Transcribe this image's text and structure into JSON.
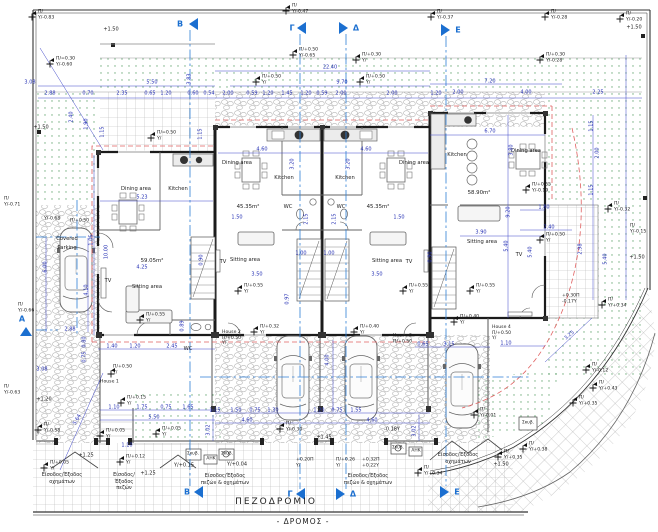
{
  "streets": {
    "sidewalk": "ΠΕΖΟΔΡΟΜΙΟ",
    "road": "- ΔΡΟΜΟΣ -"
  },
  "rooms": {
    "dining": "Dining area",
    "kitchen": "Kitchen",
    "sitting": "Sitting area",
    "tv": "TV",
    "wc": "WC",
    "covered": "Covered",
    "parking": "Parking"
  },
  "areas": {
    "h1": "59.05m²",
    "h2": "45.35m²",
    "h3": "45.35m²",
    "h4": "58.90m²"
  },
  "houses": {
    "h1": "House 1",
    "h2": "House 2",
    "h3": "House 3",
    "h4": "House 4",
    "level": "Π/+0.50",
    "datum": "Υ/"
  },
  "sections": {
    "a": "Α",
    "b": "Β",
    "g": "Γ",
    "d": "Δ",
    "e": "Ε"
  },
  "entrances": {
    "vehicles1": "Είσοδος/Έξοδος",
    "vehicles2": "οχημάτων",
    "ped1": "Είσοδος/",
    "ped2": "Έξοδος",
    "ped3": "πεζών",
    "mixed1": "Είσοδος/Έξοδος",
    "mixed2": "πεζών & οχημάτων"
  },
  "utilities": {
    "bin": "Σκυβ.",
    "power": "ΑΗΚ"
  },
  "colors": {
    "dimension": "#3e46c8",
    "section": "#1b6fd0",
    "roof_dash": "#e06060",
    "planting_dot": "#3f8f4f",
    "wall": "#1b1b1b"
  },
  "levels": [
    "+1.50",
    "+1.50",
    "+1.50",
    "+1.50",
    "+1.50",
    "+1.20",
    "+1.25",
    "+1.25",
    "+1.45",
    "Υ/+0.15",
    "Υ/+0.04"
  ],
  "dims": [
    "3.08",
    "5.50",
    "2.88",
    "0.70",
    "2.35",
    "0.65",
    "1.20",
    "0.60",
    "0.54",
    "2.00",
    "0.59",
    "1.20",
    "1.45",
    "1.20",
    "0.59",
    "2.00",
    "22.40",
    "9.70",
    "2.00",
    "2.00",
    "4.00",
    "2.25",
    "7.20",
    "6.70",
    "4.60",
    "4.60",
    "5.23",
    "3.20",
    "3.20",
    "1.50",
    "1.50",
    "3.50",
    "3.50",
    "4.25",
    "10.00",
    "6.00",
    "4.10",
    "1.05",
    "2.88",
    "3.08",
    "5.64",
    "0.80",
    "0.75",
    "1.40",
    "1.20",
    "2.45",
    "2.15",
    "2.15",
    "1.00",
    "1.00",
    "0.90",
    "0.90",
    "0.89",
    "0.97",
    "3.90",
    "9.20",
    "3.80",
    "1.80",
    "2.40",
    "5.40",
    "5.40",
    "2.98",
    "5.40",
    "1.10",
    "3.25",
    "1.15",
    "1.50",
    "0.75",
    "1.30",
    "1.20",
    "0.75",
    "1.55",
    "4.60",
    "4.60",
    "4.00",
    "3.02",
    "3.02",
    "1.10",
    "1.75",
    "0.75",
    "1.65",
    "5.50",
    "1.10",
    "0.65",
    "3.15",
    "1.15",
    "2.00",
    "1.15",
    "1.90",
    "2.40",
    "1.15",
    "3.83",
    "1.15",
    "-0.18Υ",
    "1.20"
  ],
  "marks": [
    {
      "a": "Π/",
      "b": "Υ/-0.83"
    },
    {
      "a": "Π/",
      "b": "Υ/-0.47"
    },
    {
      "a": "Π/",
      "b": "Υ/-0.37"
    },
    {
      "a": "Π/",
      "b": "Υ/-0.28"
    },
    {
      "a": "Π/",
      "b": "Υ/-0.20"
    },
    {
      "a": "Π/=0.30",
      "b": "Υ/-0.60"
    },
    {
      "a": "Π/=0.50",
      "b": "Υ/"
    },
    {
      "a": "Π/+0.50",
      "b": "Υ/-0.65"
    },
    {
      "a": "Π/+0.30",
      "b": "Υ/"
    },
    {
      "a": "Π/+0.50",
      "b": "Υ/"
    },
    {
      "a": "Π/+0.50",
      "b": "Υ/"
    },
    {
      "a": "Π/+0.30",
      "b": "Υ/-0.28"
    },
    {
      "a": "Π/+0.55",
      "b": "Υ/-0.19"
    },
    {
      "a": "Π/+0.50",
      "b": "Υ/"
    },
    {
      "a": "Π/+0.55",
      "b": "Υ/"
    },
    {
      "a": "Π/+0.55",
      "b": "Υ/"
    },
    {
      "a": "Π/+0.55",
      "b": "Υ/"
    },
    {
      "a": "Π/+0.55",
      "b": "Υ/"
    },
    {
      "a": "Π/+0.32",
      "b": "Υ/"
    },
    {
      "a": "Π/+0.40",
      "b": "Υ/"
    },
    {
      "a": "Π/+0.40",
      "b": "Υ/"
    },
    {
      "a": "Π/",
      "b": "Υ/-0.30"
    },
    {
      "a": "Π/+0.26",
      "b": "Υ/"
    },
    {
      "a": "+0.20Π",
      "b": "Υ/"
    },
    {
      "a": "+0.32Π",
      "b": "+0.22Υ"
    },
    {
      "a": "Π/+0.05",
      "b": "Υ/"
    },
    {
      "a": "Π/+0.05",
      "b": "Υ/"
    },
    {
      "a": "Π/+0.12",
      "b": "Υ/"
    },
    {
      "a": "Π/+0.05",
      "b": "Υ/"
    },
    {
      "a": "Π/",
      "b": "Υ/-0.58"
    },
    {
      "a": "Π/",
      "b": "Υ/-0.71"
    },
    {
      "a": "Π/",
      "b": "Υ/-0.63"
    },
    {
      "a": "Π/",
      "b": "Υ/-0.66"
    },
    {
      "a": "Π/",
      "b": "Υ/-0.01"
    },
    {
      "a": "Π/",
      "b": "Υ/+0.43"
    },
    {
      "a": "Π/",
      "b": "Υ/+0.35"
    },
    {
      "a": "Π/",
      "b": "Υ/+0.38"
    },
    {
      "a": "Π/",
      "b": "Υ/+0.35"
    },
    {
      "a": "Π/",
      "b": "Υ/+0.34"
    },
    {
      "a": "Π/",
      "b": "Υ/+0.34"
    },
    {
      "a": "+0.30Π",
      "b": "-0.17Υ"
    },
    {
      "a": "Π/",
      "b": "Υ/-0.12"
    },
    {
      "a": "Π/",
      "b": "Υ/-0.32"
    },
    {
      "a": "Π/",
      "b": "Υ/-0.15"
    },
    {
      "a": "Π/+0.15",
      "b": "Υ/"
    },
    {
      "a": "Υ/-0.68",
      "b": ""
    },
    {
      "a": "Π/+0.50",
      "b": ""
    },
    {
      "a": "Π/+0.50",
      "b": "Υ/"
    }
  ]
}
